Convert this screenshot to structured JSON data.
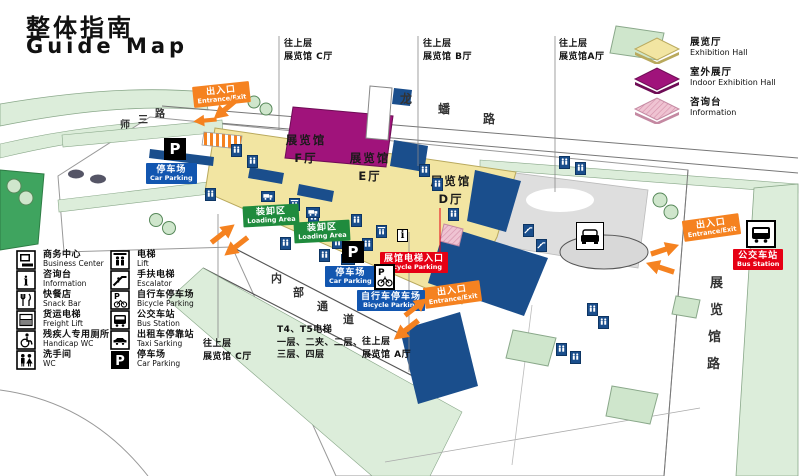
{
  "title": {
    "zh": "整体指南",
    "en": "Guide Map"
  },
  "legend": {
    "items": [
      {
        "zh": "展览厅",
        "en": "Exhibition Hall",
        "color": "#F2E5A2"
      },
      {
        "zh": "室外展厅",
        "en": "Indoor Exhibition Hall",
        "color": "#A0137B"
      },
      {
        "zh": "咨询台",
        "en": "Information",
        "color": "#EFC3D2"
      }
    ]
  },
  "roads": {
    "top": [
      "龙",
      "蟠",
      "路"
    ],
    "left": [
      "师",
      "三",
      "路"
    ],
    "right": [
      "展",
      "览",
      "馆",
      "路"
    ],
    "internal": [
      "内",
      "部",
      "通",
      "道"
    ]
  },
  "halls": {
    "f": {
      "line1": "展览馆",
      "line2": "F厅"
    },
    "e": {
      "line1": "展览馆",
      "line2": "E厅"
    },
    "d": {
      "line1": "展览馆",
      "line2": "D厅"
    }
  },
  "badges": {
    "entrance": {
      "zh": "出入口",
      "en": "Entrance/Exit"
    },
    "car_parking": {
      "zh": "停车场",
      "en": "Car Parking"
    },
    "bicycle_parking": {
      "zh": "自行车停车场",
      "en": "Bicycle Parking"
    },
    "loading_area": {
      "zh": "装卸区",
      "en": "Loading Area"
    },
    "hall_lift_entrance": {
      "zh": "展馆电梯入口",
      "en": "Bicycle Parking"
    },
    "bus_station": {
      "zh": "公交车站",
      "en": "Bus Station"
    },
    "p": "P"
  },
  "annotations": {
    "top_c": {
      "line1": "往上层",
      "line2": "展览馆 C厅"
    },
    "top_b": {
      "line1": "往上层",
      "line2": "展览馆 B厅"
    },
    "top_a": {
      "line1": "往上层",
      "line2": "展览馆A厅"
    },
    "bottom_c": {
      "line1": "往上层",
      "line2": "展览馆 C厅"
    },
    "bottom_a": {
      "line1": "往上层",
      "line2": "展览馆 A厅"
    },
    "elevator": {
      "line1": "T4、T5电梯",
      "line2": "一层、二夹、二层、",
      "line3": "三层、四层"
    }
  },
  "facility_legend": {
    "col1": [
      {
        "zh": "商务中心",
        "en": "Business Center"
      },
      {
        "zh": "咨询台",
        "en": "Information"
      },
      {
        "zh": "快餐店",
        "en": "Snack Bar"
      },
      {
        "zh": "货运电梯",
        "en": "Freight Lift"
      },
      {
        "zh": "残疾人专用厕所",
        "en": "Handicap WC"
      },
      {
        "zh": "洗手间",
        "en": "WC"
      }
    ],
    "col2": [
      {
        "zh": "电梯",
        "en": "Lift"
      },
      {
        "zh": "手扶电梯",
        "en": "Escalator"
      },
      {
        "zh": "自行车停车场",
        "en": "Bicycle Parking"
      },
      {
        "zh": "公交车站",
        "en": "Bus Station"
      },
      {
        "zh": "出租车停靠站",
        "en": "Taxi Sarking"
      },
      {
        "zh": "停车场",
        "en": "Car Parking"
      }
    ]
  },
  "map_markers": {
    "facilities": [
      {
        "type": "wc",
        "x": 231,
        "y": 144
      },
      {
        "type": "wc",
        "x": 247,
        "y": 155
      },
      {
        "type": "wc",
        "x": 205,
        "y": 188
      },
      {
        "type": "lift",
        "x": 289,
        "y": 198
      },
      {
        "type": "wc",
        "x": 308,
        "y": 211
      },
      {
        "type": "wc",
        "x": 280,
        "y": 237
      },
      {
        "type": "lift",
        "x": 332,
        "y": 236
      },
      {
        "type": "wc",
        "x": 319,
        "y": 249
      },
      {
        "type": "wc",
        "x": 351,
        "y": 214
      },
      {
        "type": "wc",
        "x": 362,
        "y": 238
      },
      {
        "type": "lift",
        "x": 376,
        "y": 225
      },
      {
        "type": "wc",
        "x": 419,
        "y": 164
      },
      {
        "type": "wc",
        "x": 432,
        "y": 178
      },
      {
        "type": "wc",
        "x": 448,
        "y": 208
      },
      {
        "type": "wc",
        "x": 559,
        "y": 156
      },
      {
        "type": "wc",
        "x": 575,
        "y": 162
      },
      {
        "type": "esc",
        "x": 523,
        "y": 224
      },
      {
        "type": "esc",
        "x": 536,
        "y": 239
      },
      {
        "type": "wc",
        "x": 587,
        "y": 303
      },
      {
        "type": "wc",
        "x": 598,
        "y": 316
      },
      {
        "type": "wc",
        "x": 556,
        "y": 343
      },
      {
        "type": "wc",
        "x": 570,
        "y": 351
      },
      {
        "type": "truck",
        "x": 261,
        "y": 191
      },
      {
        "type": "truck",
        "x": 306,
        "y": 207
      },
      {
        "type": "truck",
        "x": 341,
        "y": 254
      },
      {
        "type": "info",
        "label": "i",
        "x": 397,
        "y": 229
      }
    ]
  },
  "colors": {
    "exhibition_hall": "#F2E5A2",
    "indoor_hall": "#A0137B",
    "information": "#EFC3D2",
    "building": "#1A4E8C",
    "accent_orange": "#F58220",
    "badge_blue": "#1256B0",
    "badge_green": "#1F8B3D",
    "badge_red": "#E60014",
    "road_green": "#DCEDDA"
  }
}
